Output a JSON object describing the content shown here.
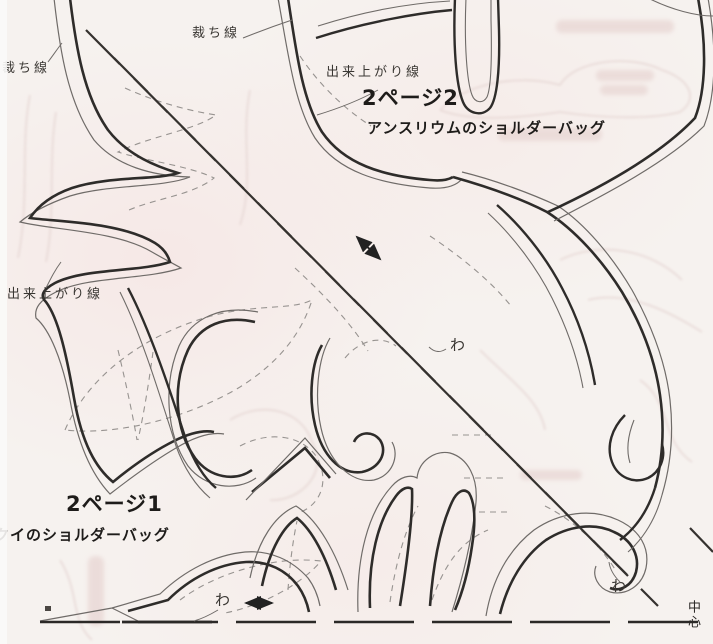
{
  "sheet": {
    "top_pattern": {
      "page_label": "2ページ2",
      "title": "アンスリウムのショルダーバッグ",
      "cut_line_label": "裁ち線",
      "cut_line_label_left": "裁ち線",
      "finished_line_label": "出来上がり線",
      "finished_line_label_left": "出来上がり線"
    },
    "bottom_pattern": {
      "page_label": "2ページ1",
      "title": "クイのショルダーバッグ"
    },
    "marks": {
      "fold_center": "わ",
      "fold_bottom": "わ",
      "fold_right": "わ",
      "center_mark": "中心"
    },
    "icons": {
      "grain_arrow": "double-arrow-diagonal",
      "fold_arrow": "double-arrow-horizontal"
    },
    "colors": {
      "paper": "#f6f2ef",
      "finished_line": "#2e2c2a",
      "cut_line": "#6f6b68",
      "quilt_dash": "#979390",
      "ghost_bleed": "#e8d9d6"
    }
  }
}
